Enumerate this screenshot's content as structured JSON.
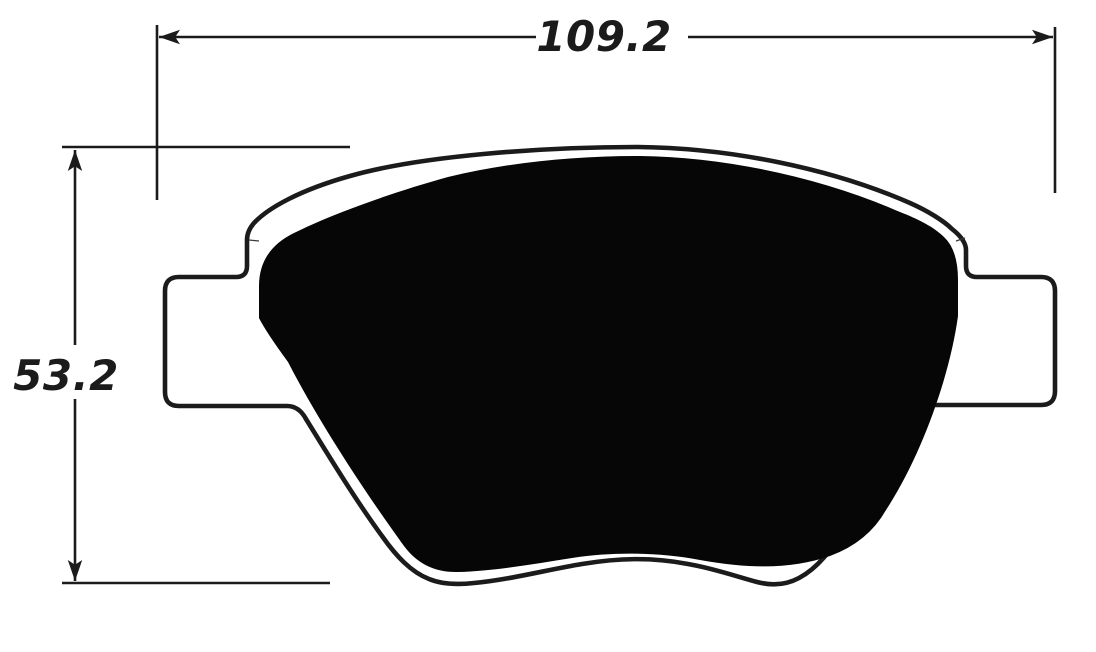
{
  "diagram": {
    "width_dimension_label": "109.2",
    "height_dimension_label": "53.2",
    "colors": {
      "line": "#1b1b1b",
      "pad_fill": "#060606",
      "plate_fill": "#ffffff",
      "background": "#ffffff"
    }
  }
}
